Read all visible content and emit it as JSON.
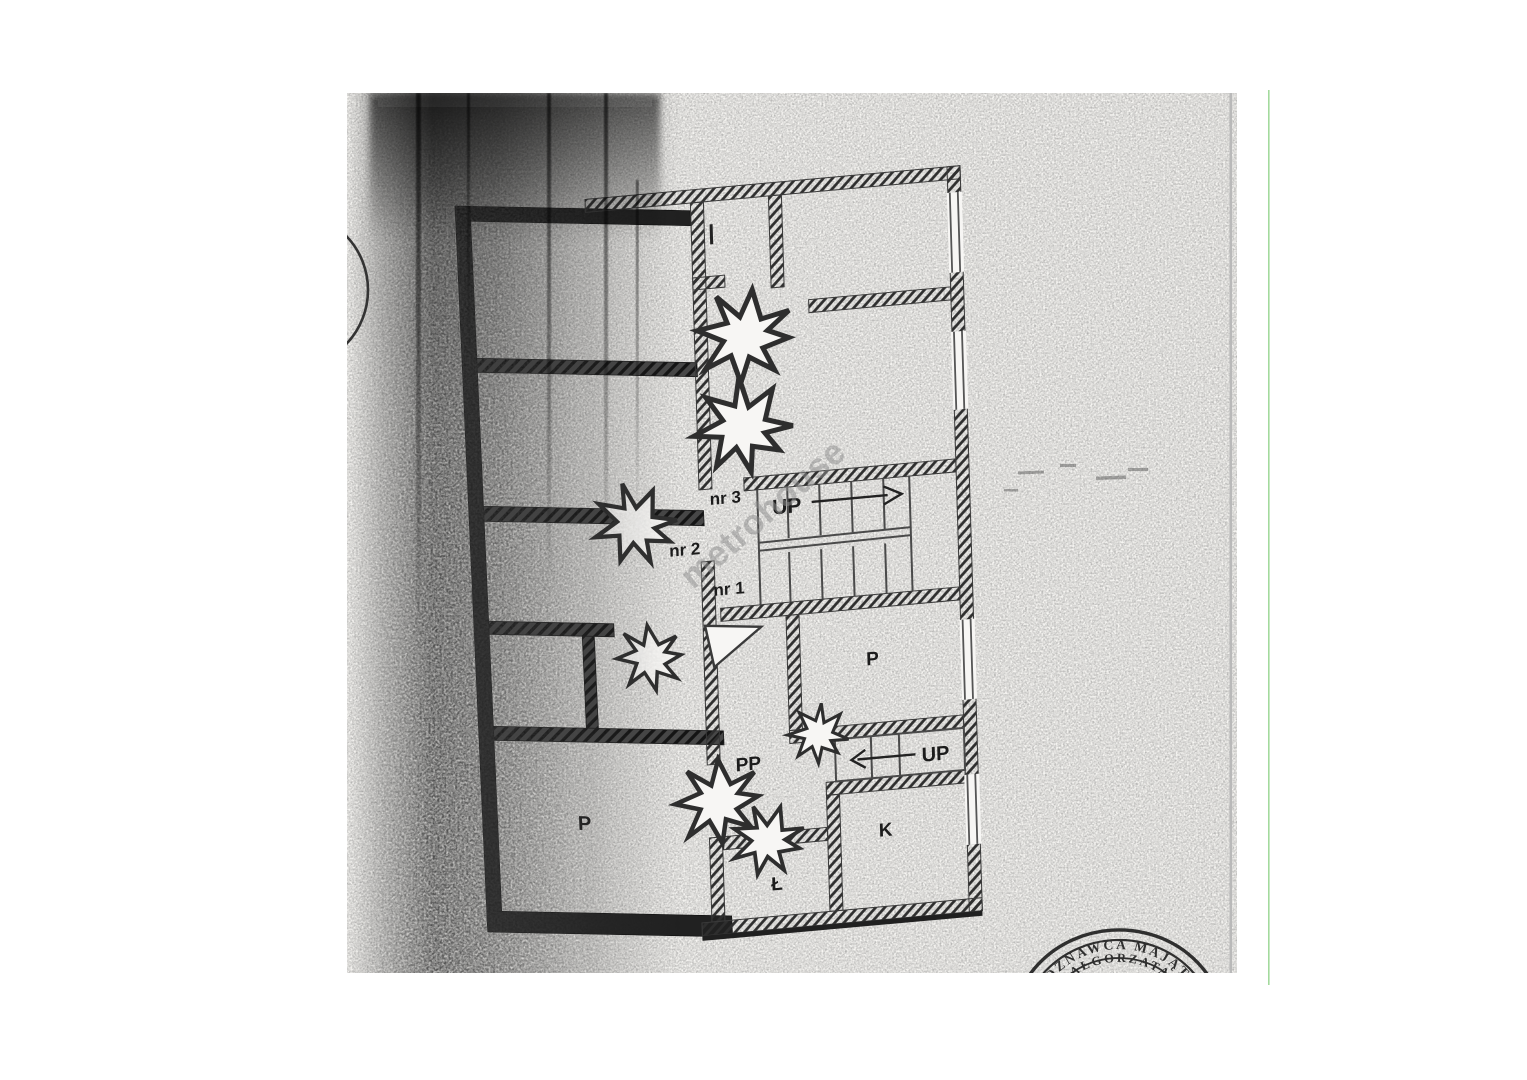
{
  "document": {
    "description": "Scanned floor plan page"
  },
  "floor_plan": {
    "door_numbers": {
      "nr1": "nr 1",
      "nr2": "nr 2",
      "nr3": "nr 3"
    },
    "rooms": {
      "p_middle": "P",
      "p_bottom_left": "P",
      "pp_hall": "PP",
      "k_room": "K",
      "l_room": "Ł"
    },
    "stairs": {
      "upper_flight_label": "UP",
      "lower_flight_label": "UP"
    }
  },
  "watermark": {
    "text": "metrohouse"
  },
  "stamp": {
    "arc_text": "ECZOZNAWCA MAJĄTKO",
    "name_text": "MAŁGORZATA"
  },
  "colors": {
    "page_background": "#f7f6f3",
    "ink": "#1f1f1f",
    "watermark_gray": "#8f8f8f",
    "scanner_line_green": "#93d48c",
    "page_edge_gray": "#b9b9b9"
  }
}
